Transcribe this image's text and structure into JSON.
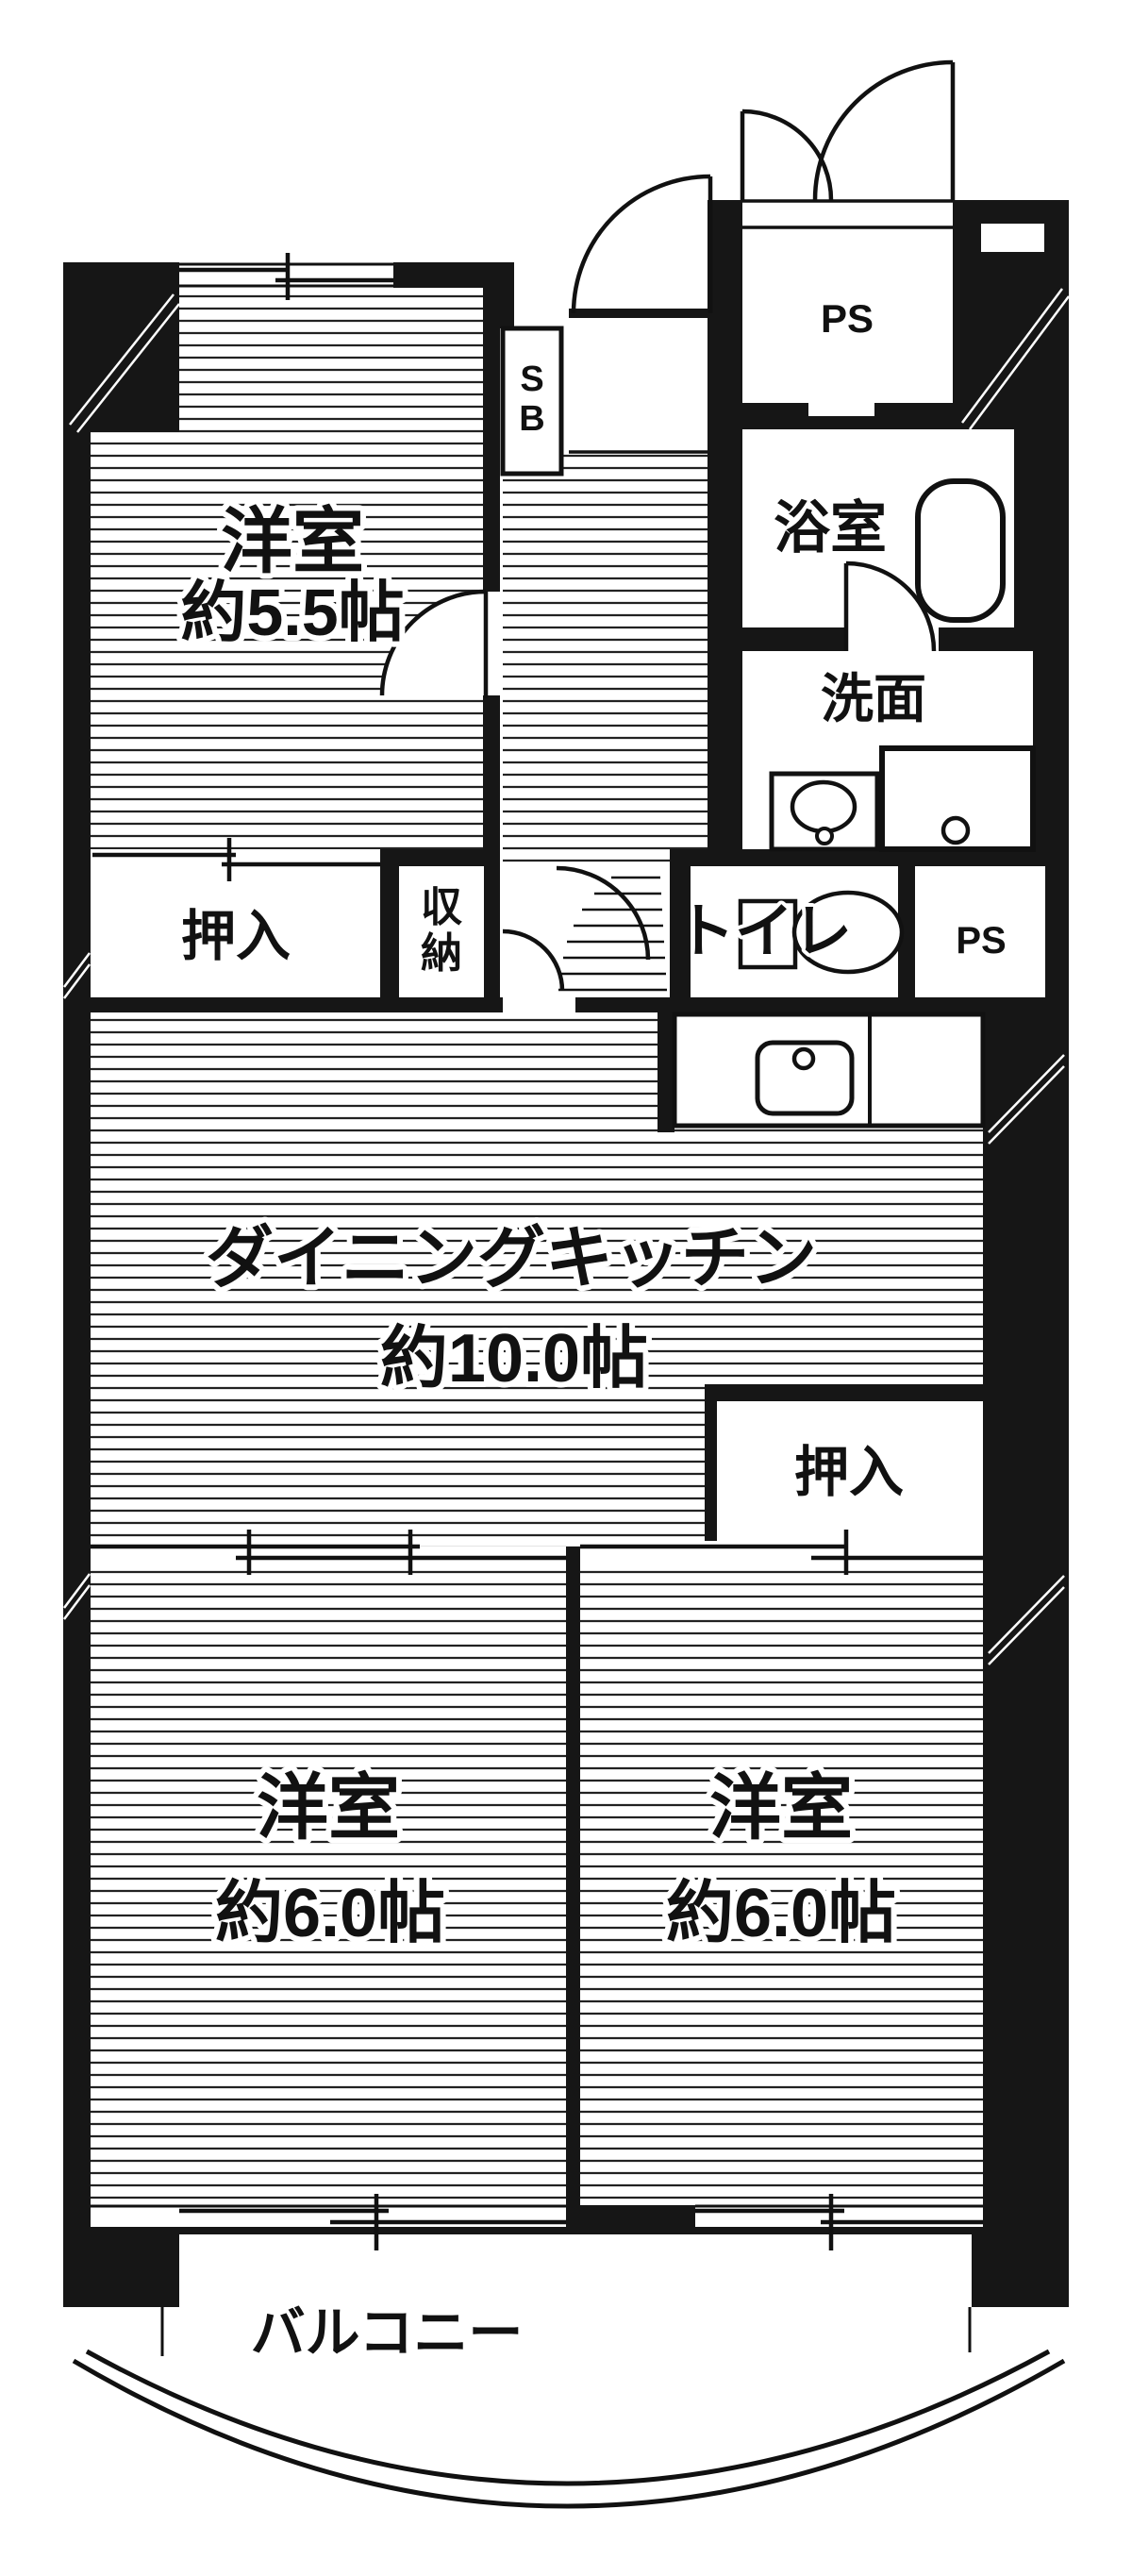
{
  "floorplan": {
    "title": "2DK apartment floor plan",
    "colors": {
      "wall": "#161616",
      "line": "#111111",
      "bg": "#ffffff",
      "hatch": "#222222"
    },
    "rooms": {
      "bed_top": {
        "name": "洋室",
        "size": "約5.5帖"
      },
      "dk": {
        "name": "ダイニングキッチン",
        "size": "約10.0帖"
      },
      "bed_left": {
        "name": "洋室",
        "size": "約6.0帖"
      },
      "bed_right": {
        "name": "洋室",
        "size": "約6.0帖"
      },
      "bath": {
        "name": "浴室"
      },
      "washroom": {
        "name": "洗面"
      },
      "toilet": {
        "name": "トイレ"
      },
      "balcony": {
        "name": "バルコニー"
      },
      "closet_top": {
        "name": "押入"
      },
      "closet_right": {
        "name": "押入"
      },
      "storage": {
        "line1": "収",
        "line2": "納"
      },
      "shoe_box": {
        "line1": "S",
        "line2": "B"
      },
      "ps_top": {
        "name": "PS"
      },
      "ps_mid": {
        "name": "PS"
      }
    }
  }
}
